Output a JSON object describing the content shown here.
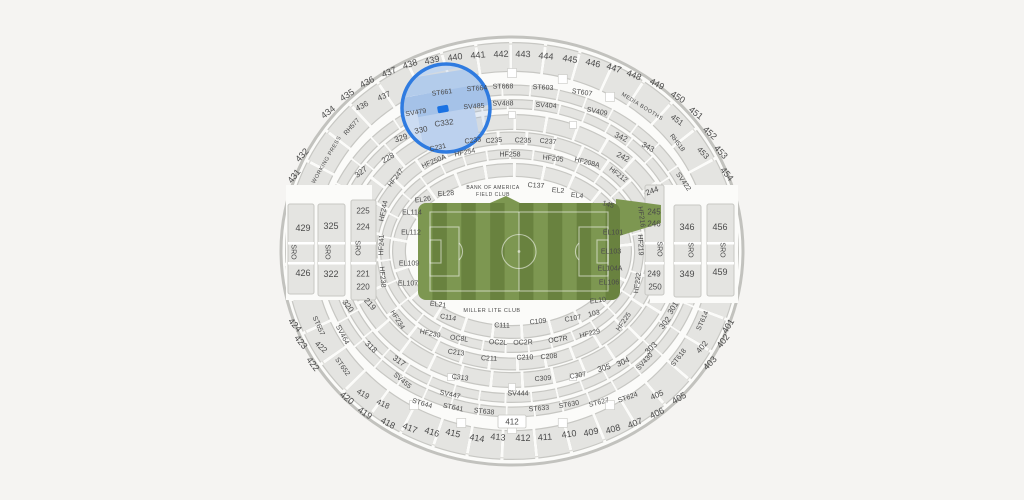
{
  "app": {
    "view": "stadium-seat-map",
    "selected_section": "C332"
  },
  "colors": {
    "page_bg": "#f5f4f2",
    "bowl_bg": "#fbfbf9",
    "section_fill": "#e4e4e1",
    "section_border": "#c7c7c3",
    "boundary": "#c2c2be",
    "label": "#4a4a4a",
    "highlight_stroke": "#2f7be0",
    "marker_fill": "#1a72e3"
  },
  "field": {
    "x": 418,
    "y": 203,
    "w": 202,
    "h": 97,
    "stripe_count": 14,
    "green_light": "#7d9751",
    "green_dark": "#69823f",
    "line": "rgba(255,255,255,0.55)",
    "extension": [
      [
        616,
        199
      ],
      [
        661,
        205
      ],
      [
        661,
        223
      ],
      [
        616,
        237
      ]
    ],
    "bump": [
      [
        490,
        203
      ],
      [
        506,
        196
      ],
      [
        520,
        203
      ]
    ]
  },
  "highlight": {
    "circle": {
      "cx": 446,
      "cy": 108,
      "r": 44,
      "width": 3.5
    },
    "tint": "rgba(150,182,228,0.22)",
    "blocks": [
      {
        "x": 406,
        "y": 56,
        "w": 62,
        "h": 16,
        "rot": -12,
        "fill": "#cfdff3"
      },
      {
        "x": 401,
        "y": 72,
        "w": 96,
        "h": 18,
        "rot": -9,
        "fill": "#bcd2ee"
      },
      {
        "x": 398,
        "y": 90,
        "w": 100,
        "h": 22,
        "rot": -10,
        "fill": "#a9c6ea"
      },
      {
        "x": 420,
        "y": 112,
        "w": 58,
        "h": 40,
        "rot": -10,
        "fill": "#c7d9f1"
      },
      {
        "x": 398,
        "y": 112,
        "w": 22,
        "h": 34,
        "rot": -10,
        "fill": "#dbe7f6"
      }
    ],
    "marker": {
      "cx": 443,
      "cy": 109,
      "w": 11,
      "h": 7,
      "rot": -10
    }
  },
  "labels": {
    "fields": [
      "text",
      "x",
      "y",
      "rotate",
      "size"
    ],
    "items": [
      [
        "431",
        294,
        176,
        -52,
        9
      ],
      [
        "432",
        302,
        155,
        -47,
        9
      ],
      [
        "434",
        328,
        112,
        -38,
        9
      ],
      [
        "435",
        347,
        95,
        -33,
        9
      ],
      [
        "436",
        367,
        82,
        -28,
        9
      ],
      [
        "437",
        389,
        72,
        -22,
        9
      ],
      [
        "438",
        410,
        64,
        -17,
        9
      ],
      [
        "439",
        432,
        60,
        -12,
        9
      ],
      [
        "440",
        455,
        57,
        -8,
        9
      ],
      [
        "441",
        478,
        55,
        -5,
        9
      ],
      [
        "442",
        501,
        54,
        -2,
        9
      ],
      [
        "443",
        523,
        54,
        1,
        9
      ],
      [
        "444",
        546,
        56,
        5,
        9
      ],
      [
        "445",
        570,
        59,
        9,
        9
      ],
      [
        "446",
        593,
        63,
        13,
        9
      ],
      [
        "447",
        614,
        68,
        18,
        9
      ],
      [
        "448",
        634,
        75,
        22,
        9
      ],
      [
        "449",
        657,
        84,
        27,
        9
      ],
      [
        "450",
        678,
        97,
        32,
        9
      ],
      [
        "451",
        696,
        113,
        38,
        9
      ],
      [
        "452",
        710,
        133,
        42,
        9
      ],
      [
        "453",
        721,
        152,
        47,
        9
      ],
      [
        "454",
        727,
        174,
        50,
        9
      ],
      [
        "436",
        362,
        106,
        -28,
        8
      ],
      [
        "437",
        384,
        96,
        -24,
        8
      ],
      [
        "451",
        677,
        120,
        36,
        8
      ],
      [
        "453",
        703,
        153,
        45,
        8
      ],
      [
        "424",
        295,
        325,
        48,
        9
      ],
      [
        "423",
        301,
        342,
        50,
        9
      ],
      [
        "422",
        321,
        347,
        42,
        8
      ],
      [
        "422",
        313,
        364,
        52,
        9
      ],
      [
        "420",
        347,
        398,
        38,
        9
      ],
      [
        "419",
        363,
        394,
        30,
        8
      ],
      [
        "419",
        365,
        413,
        33,
        9
      ],
      [
        "418",
        383,
        404,
        25,
        8
      ],
      [
        "418",
        388,
        423,
        28,
        9
      ],
      [
        "417",
        410,
        428,
        21,
        9
      ],
      [
        "416",
        432,
        432,
        17,
        9
      ],
      [
        "415",
        453,
        433,
        13,
        9
      ],
      [
        "414",
        477,
        438,
        9,
        9
      ],
      [
        "413",
        498,
        437,
        5,
        9
      ],
      [
        "412",
        523,
        438,
        0,
        9
      ],
      [
        "411",
        545,
        437,
        -4,
        9
      ],
      [
        "410",
        569,
        434,
        -8,
        9
      ],
      [
        "409",
        591,
        432,
        -12,
        9
      ],
      [
        "408",
        613,
        429,
        -16,
        9
      ],
      [
        "407",
        635,
        423,
        -21,
        9
      ],
      [
        "406",
        657,
        413,
        -26,
        9
      ],
      [
        "405",
        657,
        395,
        -24,
        8
      ],
      [
        "405",
        679,
        398,
        -30,
        9
      ],
      [
        "403",
        710,
        363,
        -46,
        9
      ],
      [
        "402",
        702,
        347,
        -50,
        8
      ],
      [
        "402",
        723,
        341,
        -53,
        9
      ],
      [
        "401",
        728,
        326,
        -58,
        9
      ],
      [
        "412",
        512,
        422,
        0,
        8
      ],
      [
        "429",
        303,
        228,
        0,
        9
      ],
      [
        "426",
        303,
        273,
        0,
        9
      ],
      [
        "325",
        331,
        226,
        0,
        9
      ],
      [
        "322",
        331,
        274,
        0,
        9
      ],
      [
        "225",
        363,
        211,
        0,
        8
      ],
      [
        "224",
        363,
        227,
        0,
        8
      ],
      [
        "221",
        363,
        274,
        0,
        8
      ],
      [
        "220",
        363,
        287,
        0,
        8
      ],
      [
        "244",
        652,
        191,
        -20,
        8
      ],
      [
        "245",
        654,
        212,
        0,
        8
      ],
      [
        "246",
        654,
        224,
        0,
        8
      ],
      [
        "249",
        654,
        274,
        0,
        8
      ],
      [
        "250",
        655,
        287,
        0,
        8
      ],
      [
        "346",
        687,
        227,
        0,
        9
      ],
      [
        "349",
        687,
        274,
        0,
        9
      ],
      [
        "456",
        720,
        227,
        0,
        9
      ],
      [
        "459",
        720,
        272,
        0,
        9
      ],
      [
        "SRO",
        293,
        252,
        90,
        7
      ],
      [
        "SRO",
        327,
        252,
        90,
        7
      ],
      [
        "SRO",
        357,
        248,
        90,
        7
      ],
      [
        "SRO",
        659,
        249,
        90,
        7
      ],
      [
        "SRO",
        690,
        250,
        90,
        7
      ],
      [
        "SRO",
        722,
        250,
        90,
        7
      ],
      [
        "327",
        361,
        172,
        -38,
        8
      ],
      [
        "329",
        401,
        138,
        -18,
        8
      ],
      [
        "330",
        421,
        130,
        -12,
        8
      ],
      [
        "342",
        621,
        137,
        25,
        8
      ],
      [
        "343",
        648,
        147,
        30,
        8
      ],
      [
        "320",
        348,
        306,
        52,
        8
      ],
      [
        "318",
        371,
        347,
        44,
        8
      ],
      [
        "317",
        399,
        361,
        36,
        8
      ],
      [
        "301",
        673,
        308,
        -58,
        8
      ],
      [
        "302",
        665,
        323,
        -52,
        8
      ],
      [
        "303",
        651,
        348,
        -44,
        8
      ],
      [
        "304",
        623,
        362,
        -24,
        8
      ],
      [
        "305",
        604,
        368,
        -16,
        8
      ],
      [
        "228",
        388,
        158,
        -30,
        8
      ],
      [
        "242",
        623,
        157,
        28,
        8
      ],
      [
        "219",
        370,
        304,
        48,
        8
      ],
      [
        "C231",
        438,
        148,
        -12,
        7
      ],
      [
        "C233",
        473,
        141,
        -8,
        7
      ],
      [
        "C235",
        494,
        141,
        -4,
        7
      ],
      [
        "C235",
        523,
        141,
        2,
        7
      ],
      [
        "C237",
        548,
        142,
        5,
        7
      ],
      [
        "C137",
        536,
        186,
        3,
        7
      ],
      [
        "C332",
        444,
        123,
        -8,
        8
      ],
      [
        "ST661",
        442,
        93,
        -8,
        7
      ],
      [
        "ST664",
        477,
        89,
        -4,
        7
      ],
      [
        "ST668",
        503,
        87,
        -1,
        7
      ],
      [
        "ST603",
        543,
        88,
        3,
        7
      ],
      [
        "ST607",
        582,
        93,
        8,
        7
      ],
      [
        "SV479",
        416,
        113,
        -10,
        7
      ],
      [
        "SV485",
        474,
        107,
        -4,
        7
      ],
      [
        "SV488",
        503,
        104,
        -1,
        7
      ],
      [
        "SV404",
        546,
        106,
        4,
        7
      ],
      [
        "SV409",
        597,
        112,
        12,
        7
      ],
      [
        "HF250A",
        434,
        162,
        -23,
        7
      ],
      [
        "HF254",
        465,
        153,
        -12,
        7
      ],
      [
        "HF258",
        510,
        155,
        0,
        7
      ],
      [
        "HF205",
        553,
        159,
        7,
        7
      ],
      [
        "HF208A",
        587,
        163,
        14,
        7
      ],
      [
        "HF212",
        618,
        175,
        38,
        7
      ],
      [
        "HF247",
        396,
        178,
        -52,
        7
      ],
      [
        "HF244",
        384,
        211,
        -78,
        7
      ],
      [
        "HF241",
        382,
        245,
        -88,
        7
      ],
      [
        "HF238",
        382,
        277,
        85,
        7
      ],
      [
        "HF234",
        397,
        320,
        58,
        7
      ],
      [
        "HF230",
        430,
        334,
        12,
        7
      ],
      [
        "HF216",
        641,
        217,
        82,
        7
      ],
      [
        "HF219",
        640,
        245,
        88,
        7
      ],
      [
        "HF222",
        638,
        283,
        -82,
        7
      ],
      [
        "HF225",
        624,
        322,
        -55,
        7
      ],
      [
        "HF229",
        590,
        334,
        -14,
        7
      ],
      [
        "OC8L",
        459,
        339,
        8,
        7
      ],
      [
        "OC2L",
        498,
        343,
        3,
        7
      ],
      [
        "OC2R",
        523,
        343,
        -2,
        7
      ],
      [
        "OC7R",
        558,
        340,
        -8,
        7
      ],
      [
        "C114",
        448,
        318,
        10,
        7
      ],
      [
        "C111",
        502,
        326,
        2,
        7
      ],
      [
        "C109",
        538,
        322,
        -6,
        7
      ],
      [
        "C107",
        573,
        319,
        -10,
        7
      ],
      [
        "103",
        594,
        314,
        -14,
        7
      ],
      [
        "C213",
        456,
        353,
        8,
        7
      ],
      [
        "C211",
        489,
        359,
        3,
        7
      ],
      [
        "C210",
        525,
        358,
        -2,
        7
      ],
      [
        "C208",
        549,
        357,
        -5,
        7
      ],
      [
        "C313",
        460,
        378,
        8,
        7
      ],
      [
        "C309",
        543,
        379,
        -4,
        7
      ],
      [
        "C307",
        578,
        376,
        -10,
        7
      ],
      [
        "EL114",
        412,
        213,
        0,
        7
      ],
      [
        "EL112",
        411,
        233,
        0,
        7
      ],
      [
        "EL109",
        409,
        264,
        0,
        7
      ],
      [
        "EL107",
        408,
        284,
        0,
        7
      ],
      [
        "EL26",
        423,
        200,
        -8,
        7
      ],
      [
        "EL28",
        446,
        194,
        -4,
        7
      ],
      [
        "EL2",
        558,
        191,
        5,
        7
      ],
      [
        "EL4",
        577,
        196,
        8,
        7
      ],
      [
        "EL101",
        613,
        233,
        0,
        7
      ],
      [
        "EL103",
        611,
        252,
        0,
        7
      ],
      [
        "EL104A",
        610,
        269,
        0,
        7
      ],
      [
        "EL106",
        609,
        283,
        0,
        7
      ],
      [
        "EL10",
        598,
        301,
        -8,
        7
      ],
      [
        "EL21",
        438,
        305,
        8,
        7
      ],
      [
        "145",
        608,
        205,
        15,
        7
      ],
      [
        "SV455",
        402,
        381,
        40,
        7
      ],
      [
        "SV447",
        450,
        395,
        12,
        7
      ],
      [
        "SV444",
        518,
        394,
        0,
        7
      ],
      [
        "SV430",
        645,
        362,
        -48,
        7
      ],
      [
        "SV464",
        342,
        335,
        62,
        7
      ],
      [
        "ST652",
        342,
        367,
        55,
        7
      ],
      [
        "ST657",
        318,
        326,
        66,
        7
      ],
      [
        "ST644",
        422,
        404,
        17,
        7
      ],
      [
        "ST641",
        453,
        408,
        12,
        7
      ],
      [
        "ST638",
        484,
        412,
        6,
        7
      ],
      [
        "ST633",
        539,
        409,
        -5,
        7
      ],
      [
        "ST630",
        569,
        405,
        -10,
        7
      ],
      [
        "ST627",
        599,
        403,
        -14,
        7
      ],
      [
        "ST624",
        628,
        398,
        -19,
        7
      ],
      [
        "ST618",
        679,
        358,
        -52,
        7
      ],
      [
        "ST614",
        703,
        321,
        -66,
        7
      ],
      [
        "SV422",
        683,
        182,
        55,
        7
      ],
      [
        "RH577",
        352,
        127,
        -48,
        6.5
      ],
      [
        "RH518",
        677,
        143,
        52,
        6.5
      ],
      [
        "WORKING PRESS",
        327,
        160,
        -60,
        5.5
      ],
      [
        "MEDIA BOOTHS",
        642,
        107,
        32,
        5.5
      ],
      [
        "BANK OF AMERICA",
        493,
        188,
        0,
        5
      ],
      [
        "FIELD CLUB",
        493,
        195,
        0,
        5
      ],
      [
        "MILLER LITE CLUB",
        492,
        311,
        0,
        5.5
      ]
    ]
  }
}
